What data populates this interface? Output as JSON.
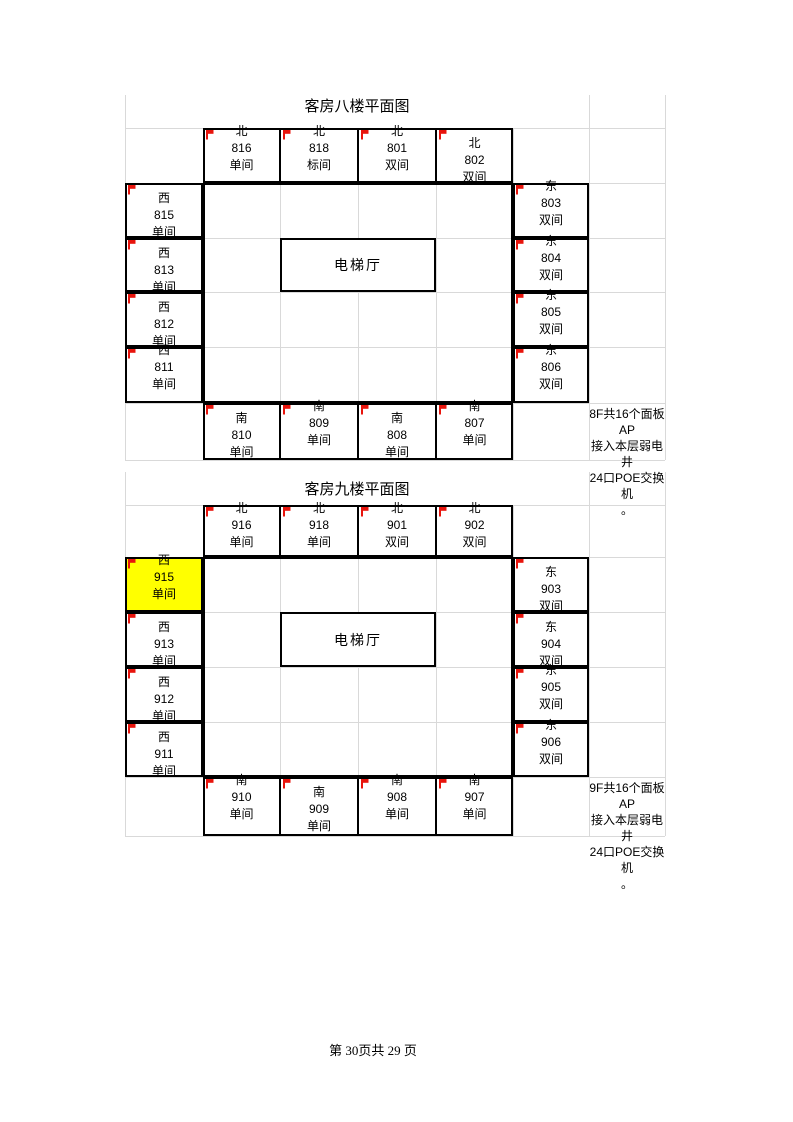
{
  "colors": {
    "flag_red": "#e8140c",
    "highlight_yellow": "#ffff00",
    "grid_line": "#d9d9d9",
    "room_border": "#000000"
  },
  "footer": {
    "text": "第 30页共 29 页"
  },
  "floors": [
    {
      "name": "floor-8",
      "title": "客房八楼平面图",
      "elevator": "电梯厅",
      "note": [
        "8F共16个面板AP",
        "接入本层弱电井",
        "24口POE交换机",
        "。"
      ],
      "north": [
        {
          "dir": "北",
          "num": "816",
          "type": "单间",
          "offset": "up"
        },
        {
          "dir": "北",
          "num": "818",
          "type": "标间",
          "offset": "up"
        },
        {
          "dir": "北",
          "num": "801",
          "type": "双间",
          "offset": "up"
        },
        {
          "dir": "北",
          "num": "802",
          "type": "双间",
          "offset": "center"
        }
      ],
      "west": [
        {
          "dir": "西",
          "num": "815",
          "type": "单间",
          "offset": "center"
        },
        {
          "dir": "西",
          "num": "813",
          "type": "单间",
          "offset": "center"
        },
        {
          "dir": "西",
          "num": "812",
          "type": "单间",
          "offset": "center"
        },
        {
          "dir": "西",
          "num": "811",
          "type": "单间",
          "offset": "up"
        }
      ],
      "east": [
        {
          "dir": "东",
          "num": "803",
          "type": "双间",
          "offset": "up"
        },
        {
          "dir": "东",
          "num": "804",
          "type": "双间",
          "offset": "up"
        },
        {
          "dir": "东",
          "num": "805",
          "type": "双间",
          "offset": "up"
        },
        {
          "dir": "东",
          "num": "806",
          "type": "双间",
          "offset": "up"
        }
      ],
      "south": [
        {
          "dir": "南",
          "num": "810",
          "type": "单间",
          "offset": "center"
        },
        {
          "dir": "南",
          "num": "809",
          "type": "单间",
          "offset": "up"
        },
        {
          "dir": "南",
          "num": "808",
          "type": "单间",
          "offset": "center"
        },
        {
          "dir": "南",
          "num": "807",
          "type": "单间",
          "offset": "up"
        }
      ]
    },
    {
      "name": "floor-9",
      "title": "客房九楼平面图",
      "elevator": "电梯厅",
      "note": [
        "9F共16个面板AP",
        "接入本层弱电井",
        "24口POE交换机",
        "。"
      ],
      "north": [
        {
          "dir": "北",
          "num": "916",
          "type": "单间",
          "offset": "up"
        },
        {
          "dir": "北",
          "num": "918",
          "type": "单间",
          "offset": "up"
        },
        {
          "dir": "北",
          "num": "901",
          "type": "双间",
          "offset": "up"
        },
        {
          "dir": "北",
          "num": "902",
          "type": "双间",
          "offset": "up"
        }
      ],
      "west": [
        {
          "dir": "西",
          "num": "915",
          "type": "单间",
          "offset": "up",
          "highlight": true
        },
        {
          "dir": "西",
          "num": "913",
          "type": "单间",
          "offset": "center"
        },
        {
          "dir": "西",
          "num": "912",
          "type": "单间",
          "offset": "center"
        },
        {
          "dir": "西",
          "num": "911",
          "type": "单间",
          "offset": "center"
        }
      ],
      "east": [
        {
          "dir": "东",
          "num": "903",
          "type": "双间",
          "offset": "center"
        },
        {
          "dir": "东",
          "num": "904",
          "type": "双间",
          "offset": "center"
        },
        {
          "dir": "东",
          "num": "905",
          "type": "双间",
          "offset": "up"
        },
        {
          "dir": "东",
          "num": "906",
          "type": "双间",
          "offset": "up"
        }
      ],
      "south": [
        {
          "dir": "南",
          "num": "910",
          "type": "单间",
          "offset": "up"
        },
        {
          "dir": "南",
          "num": "909",
          "type": "单间",
          "offset": "center"
        },
        {
          "dir": "南",
          "num": "908",
          "type": "单间",
          "offset": "up"
        },
        {
          "dir": "南",
          "num": "907",
          "type": "单间",
          "offset": "up"
        }
      ]
    }
  ]
}
